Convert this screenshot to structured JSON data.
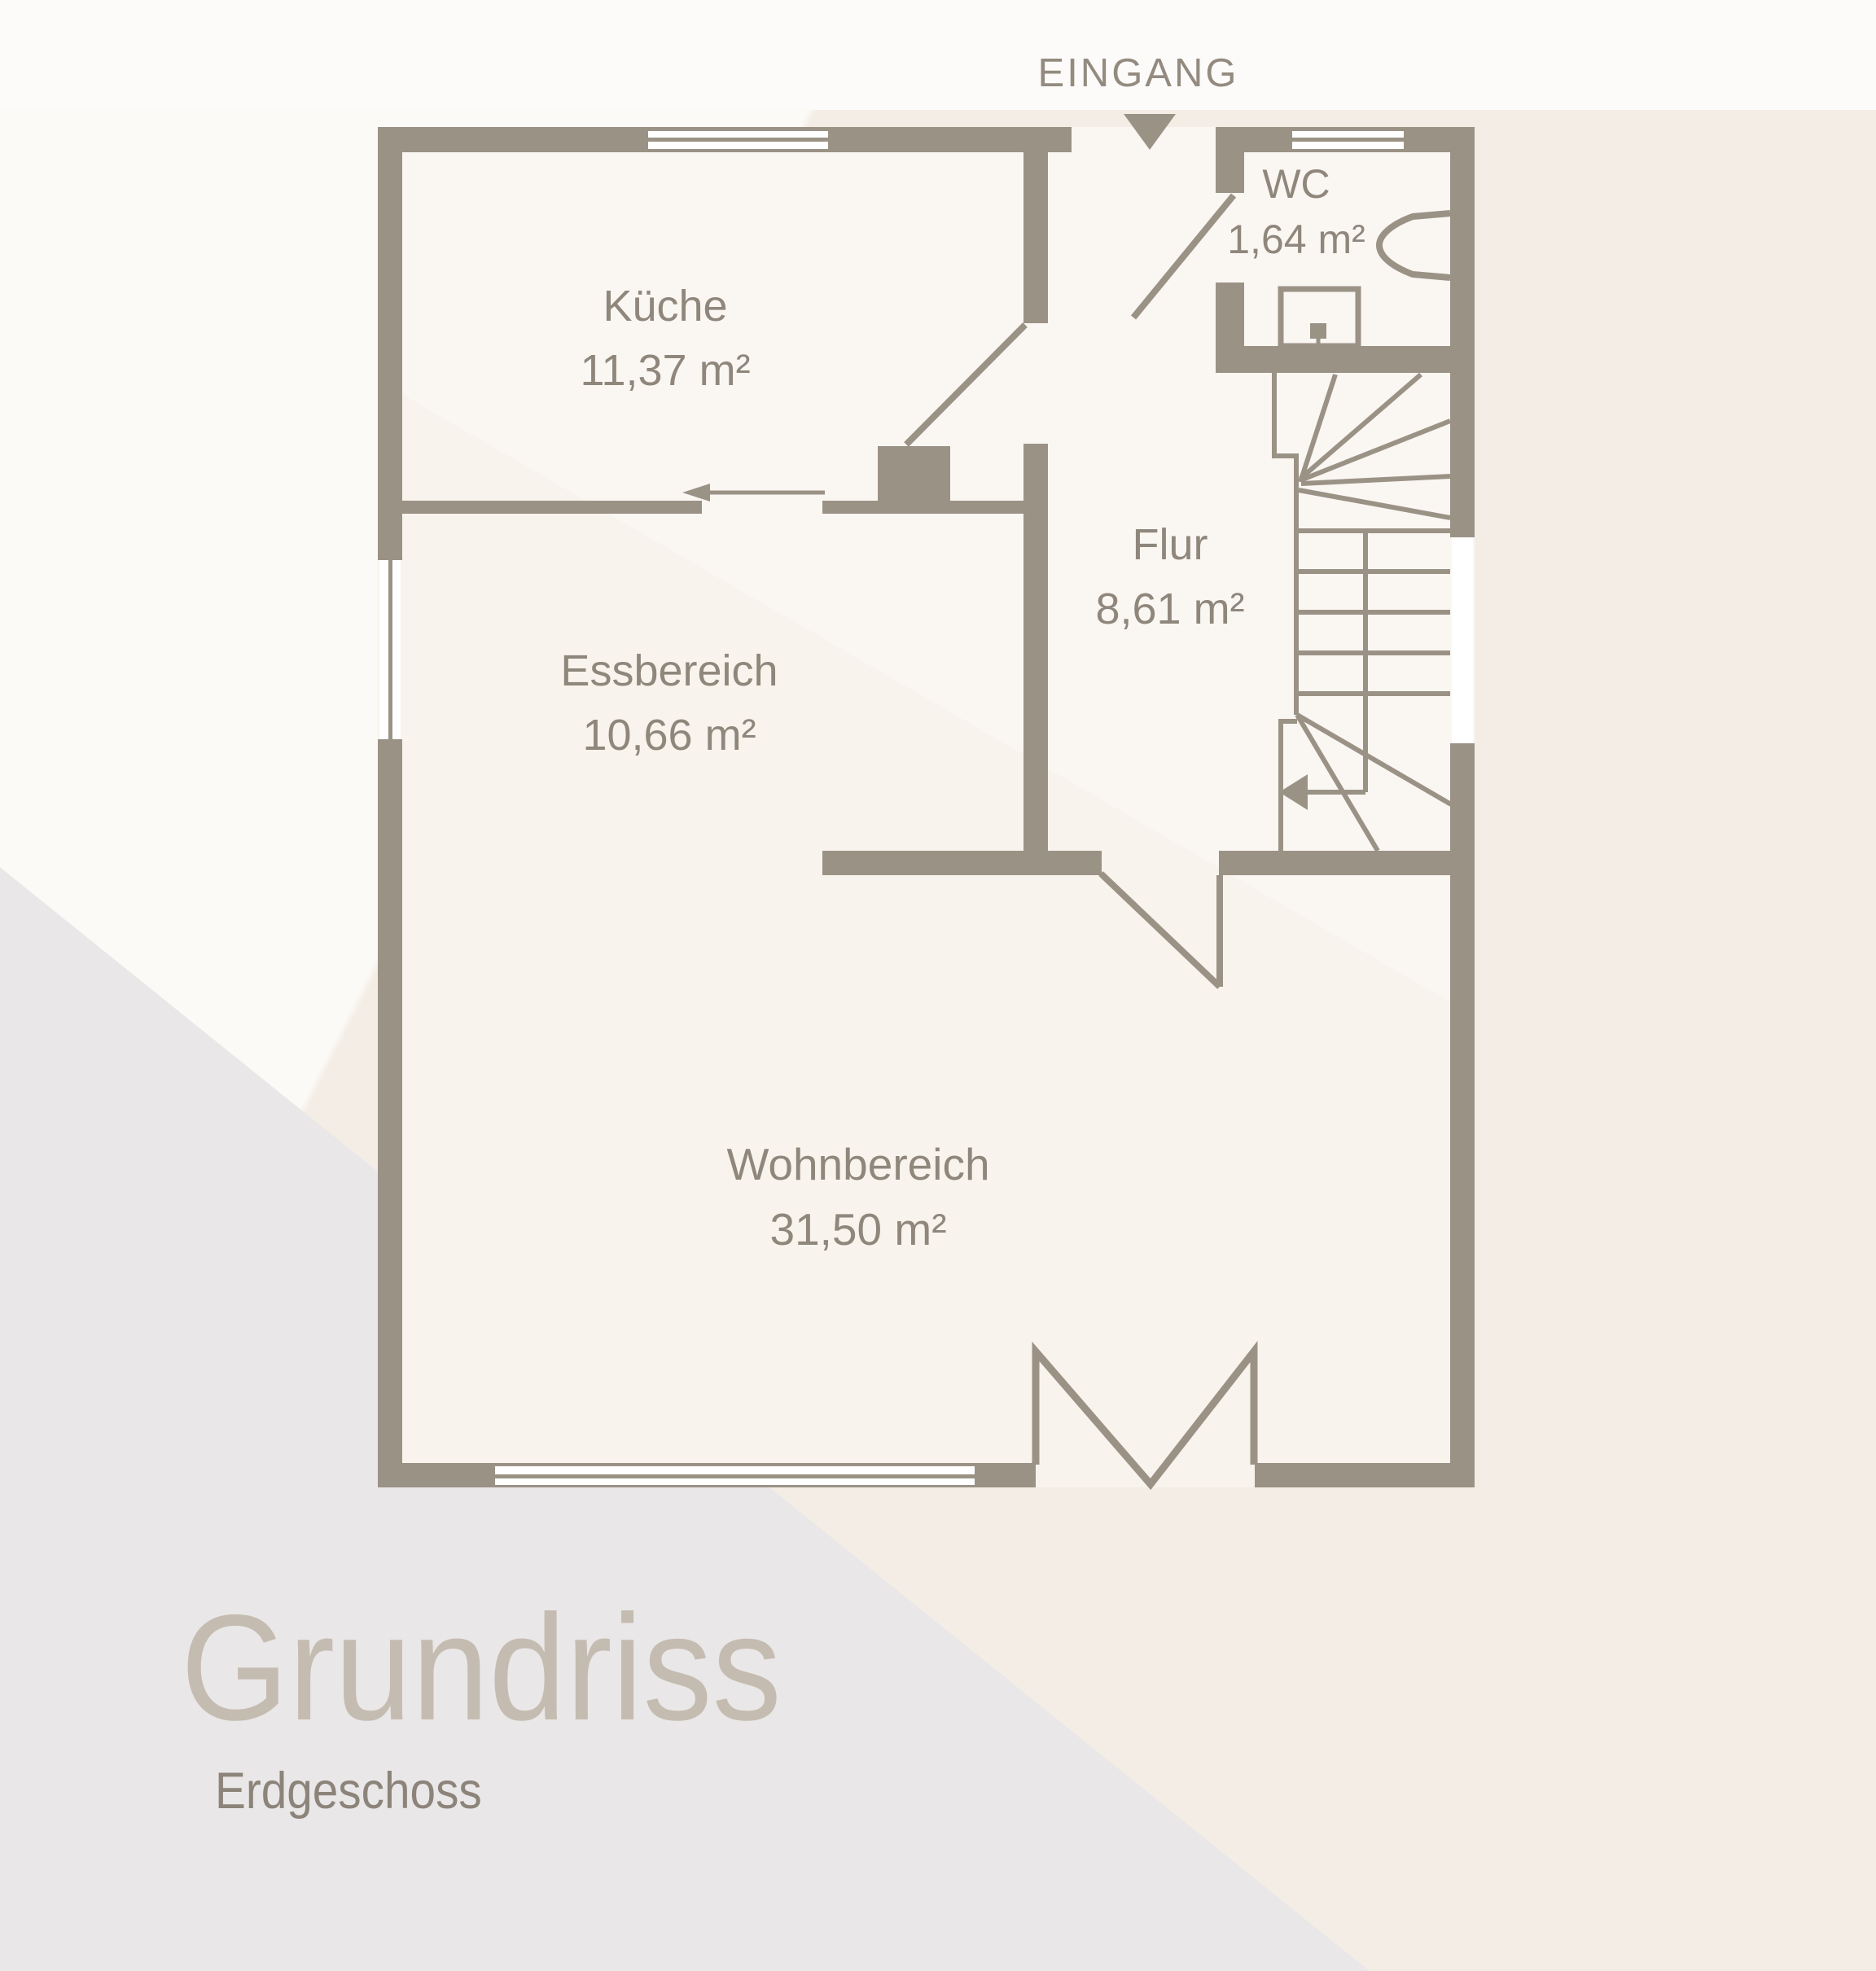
{
  "title": {
    "main": "Grundriss",
    "subtitle": "Erdgeschoss"
  },
  "labels": {
    "entrance": "EINGANG"
  },
  "rooms": {
    "kueche": {
      "name": "Küche",
      "area": "11,37 m²"
    },
    "wc": {
      "name": "WC",
      "area": "1,64 m²"
    },
    "flur": {
      "name": "Flur",
      "area": "8,61 m²"
    },
    "essbereich": {
      "name": "Essbereich",
      "area": "10,66 m²"
    },
    "wohnbereich": {
      "name": "Wohnbereich",
      "area": "31,50 m²"
    }
  },
  "icons": {
    "entrance_arrow": "down-triangle-icon",
    "stairs_direction": "left-arrow-icon",
    "kitchen_passage": "left-arrow-icon",
    "wc_fixtures": [
      "toilet-icon",
      "sink-icon"
    ]
  },
  "colors": {
    "wall": "#9b9286",
    "floor": "#f8f3ec",
    "background": "#f3ede5",
    "panel_gray": "#e9e7e7",
    "label_text": "#8f877c",
    "title_text": "#c5bcb1"
  }
}
